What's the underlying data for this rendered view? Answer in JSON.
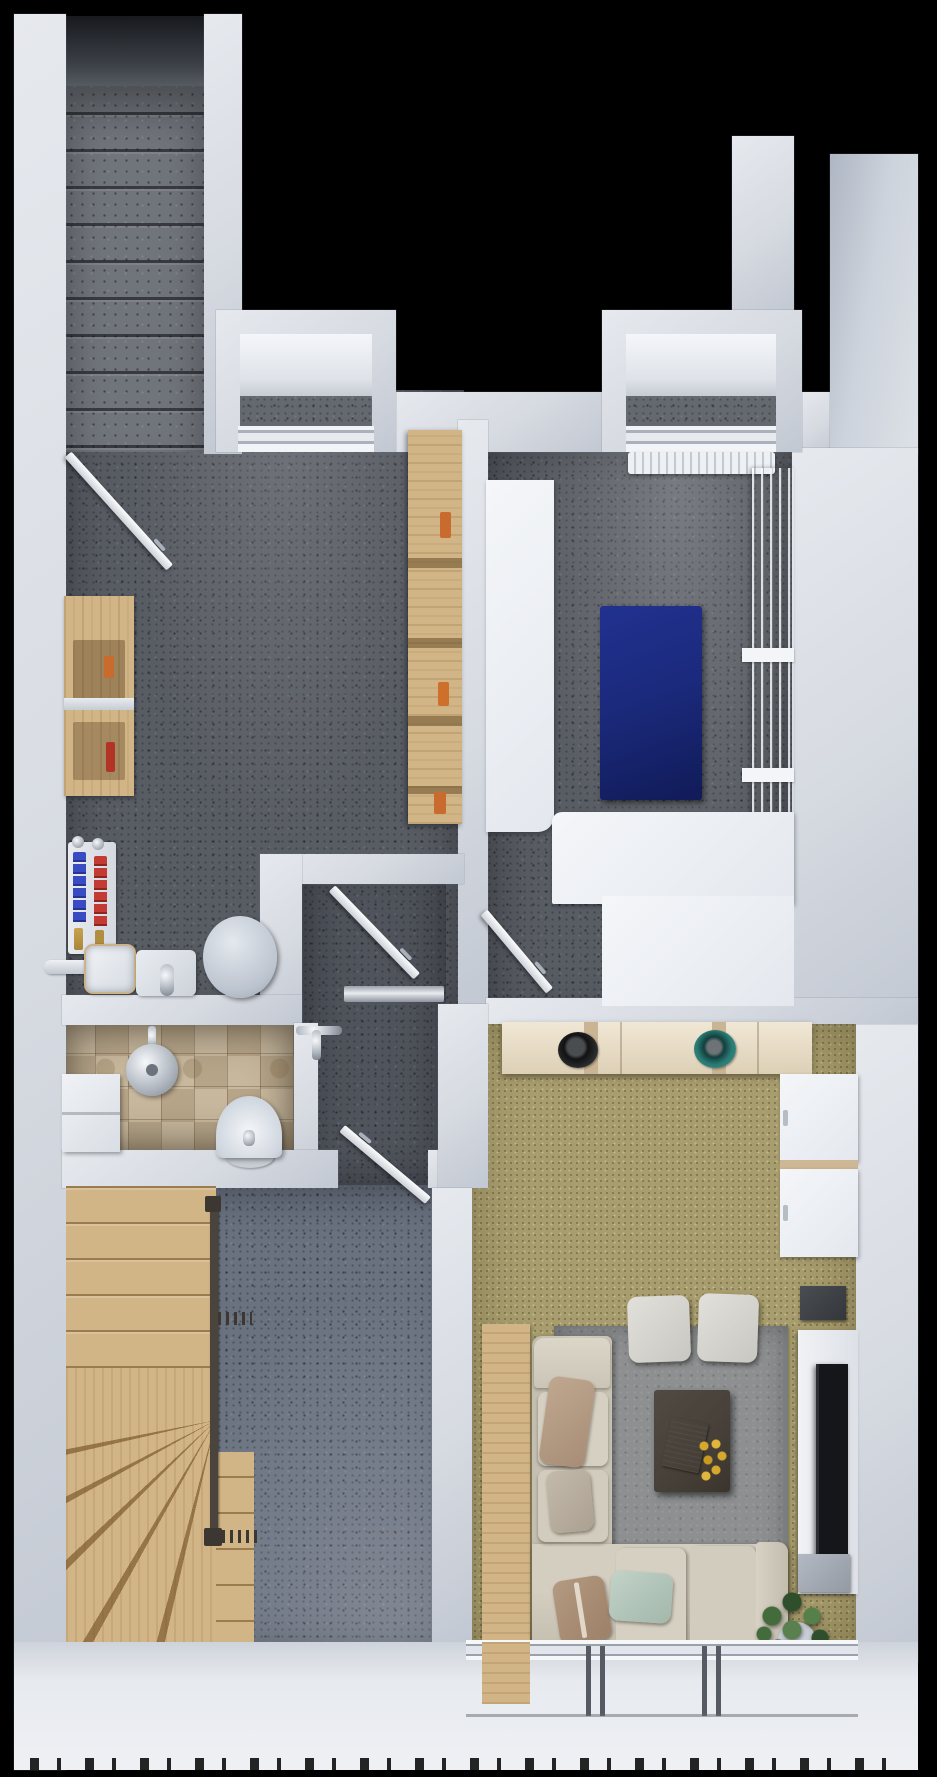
{
  "scene": {
    "type": "3d-floorplan-top-down-render",
    "level": "basement-floor-dollhouse-view",
    "background": "#000000",
    "visible_text": "none"
  },
  "palette": {
    "bg": "#000000",
    "wall": "#d6dae1",
    "wallHi": "#e6e9ee",
    "wallLo": "#c2c8d2",
    "floorDark": "#585c63",
    "floorHall": "#50545c",
    "floorStairHall": "#6a7280",
    "carpet": "#a89d6e",
    "tileA": "#b7a589",
    "tileB": "#c8b89d",
    "wood": "#d2b587",
    "matBlue": "#1b2a7d",
    "bowlTeal": "#3f948e",
    "bowlBlack": "#232526",
    "manifoldBlue": "#3a4cc4",
    "manifoldRed": "#c23b34",
    "sofa": "#cfc9bc",
    "pillowBrown": "#b49a82",
    "pillowMint": "#c2d3c8",
    "tableBrown": "#474038",
    "flowerYellow": "#d6a82c",
    "plantGreen": "#3f6138",
    "tvDark": "#141619"
  },
  "rooms": [
    {
      "id": "upper-stair-shaft",
      "name": "concrete staircase flight",
      "floor": "concrete-steps",
      "items": [
        "concrete-steps",
        "dark-landing"
      ]
    },
    {
      "id": "storage-room",
      "name": "storage and utility room",
      "floor": "dark-speckled-concrete",
      "items": [
        "entry-door",
        "wooden-workbench",
        "wooden-shelving-unit",
        "heating-manifold-red-blue",
        "brass-valves",
        "towel-bar",
        "utility-sink",
        "cistern-box",
        "round-water-heater",
        "light-well-window"
      ]
    },
    {
      "id": "fitness-room",
      "name": "hobby / fitness room",
      "floor": "dark-speckled-concrete",
      "items": [
        "tall-white-cabinet",
        "blue-exercise-mat",
        "white-locker-row",
        "corner-bench-white",
        "radiator-under-window",
        "entry-door",
        "light-well-window"
      ]
    },
    {
      "id": "hallway",
      "name": "central hallway",
      "floor": "dark-speckled-concrete",
      "items": [
        "swing-door",
        "metal-threshold"
      ]
    },
    {
      "id": "bathroom",
      "name": "tiled bathroom",
      "floor": "beige-checker-tiles",
      "items": [
        "shower-head",
        "mixer-tap",
        "washbasin",
        "step-bench"
      ]
    },
    {
      "id": "stair-hall",
      "name": "lower stair hall",
      "floor": "blue-gray-speckled",
      "items": [
        "wooden-winder-staircase",
        "handrail",
        "newel-posts",
        "baluster-fence",
        "swing-door"
      ]
    },
    {
      "id": "living-room",
      "name": "living room",
      "floor": "olive-carpet",
      "items": [
        "cream-sideboard",
        "black-decor-bowl",
        "teal-decor-bowl",
        "white-wall-cabinet",
        "white-wall-cabinet",
        "dark-wall-shelf",
        "media-panel",
        "flat-tv",
        "lower-media-shelf",
        "area-rug",
        "wooden-sideboard",
        "corner-sofa",
        "pillow-brown-striped",
        "pillow-gray",
        "pillow-brown",
        "pillow-mint",
        "ottoman",
        "ottoman",
        "coffee-table",
        "open-book",
        "yellow-flower-bouquet",
        "potted-plant",
        "sliding-glass-door-mullions"
      ]
    }
  ],
  "windows": [
    "light-well-left",
    "light-well-right",
    "terrace-sliding-glazing"
  ],
  "counts": {
    "doors": 4,
    "light_wells": 2,
    "ottomans": 2,
    "wall_cabinets": 2
  }
}
